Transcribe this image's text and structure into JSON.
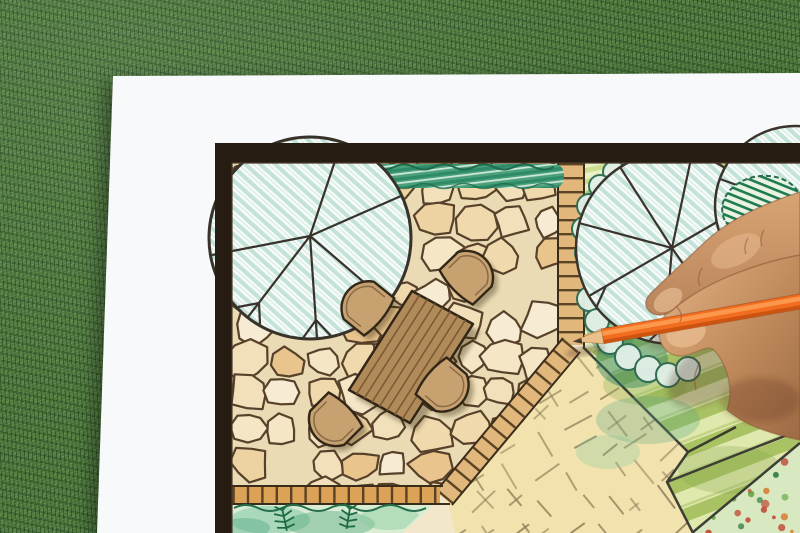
{
  "meta": {
    "alt": "Close-up photo of a hand holding an orange colored pencil over a hand-drawn garden landscape architecture plan on white paper, lying on green grass",
    "canvas": {
      "width": 800,
      "height": 533
    }
  },
  "scene": {
    "labels": {
      "stage": "Garden landscape plan being colored with an orange pencil on grass background",
      "grass": "green lawn turf background",
      "paper": "white drawing paper sheet",
      "plan": "hand-drawn garden plan with colored pencils",
      "frame": "dark plan border frame",
      "patio": "flagstone patio paving",
      "hedge": "green hedge strip",
      "shade_tree": "large round shade tree symbol with branch lines",
      "table": "rectangular wooden outdoor table symbol",
      "chair": "rounded patio chair symbol",
      "brick_path": "brick edging and stepping path",
      "planting_area": "planting area with two round trees and shrub clouds",
      "sand_area": "pale sand paving area with hatch marks",
      "lawn_area": "striped green lawn area",
      "fern_bed": "planting bed with ferns",
      "flower_bed": "corner flower bed with colorful dots",
      "hand": "hand of the designer",
      "pencil": "orange colored pencil"
    }
  },
  "palette": {
    "grass": "#4c763b",
    "paper": "#f8f9fa",
    "frame": "#271c12",
    "stoneBase": "#eadbb4",
    "stoneOutline": "#57412a",
    "stoneFills": [
      "#f7ecd3",
      "#f2e0ba",
      "#eed3a2",
      "#e9c48d",
      "#f5e6c6",
      "#efd9ad"
    ],
    "sand": "#f2e3ae",
    "sandDash": "#8d7a55",
    "brick": "#e1b77c",
    "brickRung": "#5b4424",
    "brickBottom": "#dba258",
    "hedgeDark": "#2e8a68",
    "hedgeLight": "#cfe7da",
    "hedgeMid": "#49a079",
    "treeHatch": "#c3e2d8",
    "cloudFill": "#e2f0e8",
    "cloudStroke": "#2d6a52",
    "tealBlob": "#3f8f6e",
    "ink": "#3a342c",
    "plantDark": "#cede8e",
    "plantLight": "#e9f0c6",
    "lawnDark": "#a9c264",
    "lawnLight": "#dfe8ad",
    "fern": "#1d6b44",
    "tableFill": "#b18a59",
    "tablePlank": "#7c5a36",
    "furnitureOutline": "#322717",
    "chairFill": "#c8a171",
    "skin": "#cf9a6d",
    "skinLight": "#f0c79a",
    "skinShadow": "#8a5a3a",
    "pencil": "#f26d1f",
    "pencilDark": "#cc5410",
    "pencilLight": "#ffa75c",
    "pencilWood": "#ecc189",
    "graphite": "#473a2b"
  },
  "generator": {
    "stoneSeed": 7,
    "dashSeed": 3,
    "dotSeed": 11
  }
}
